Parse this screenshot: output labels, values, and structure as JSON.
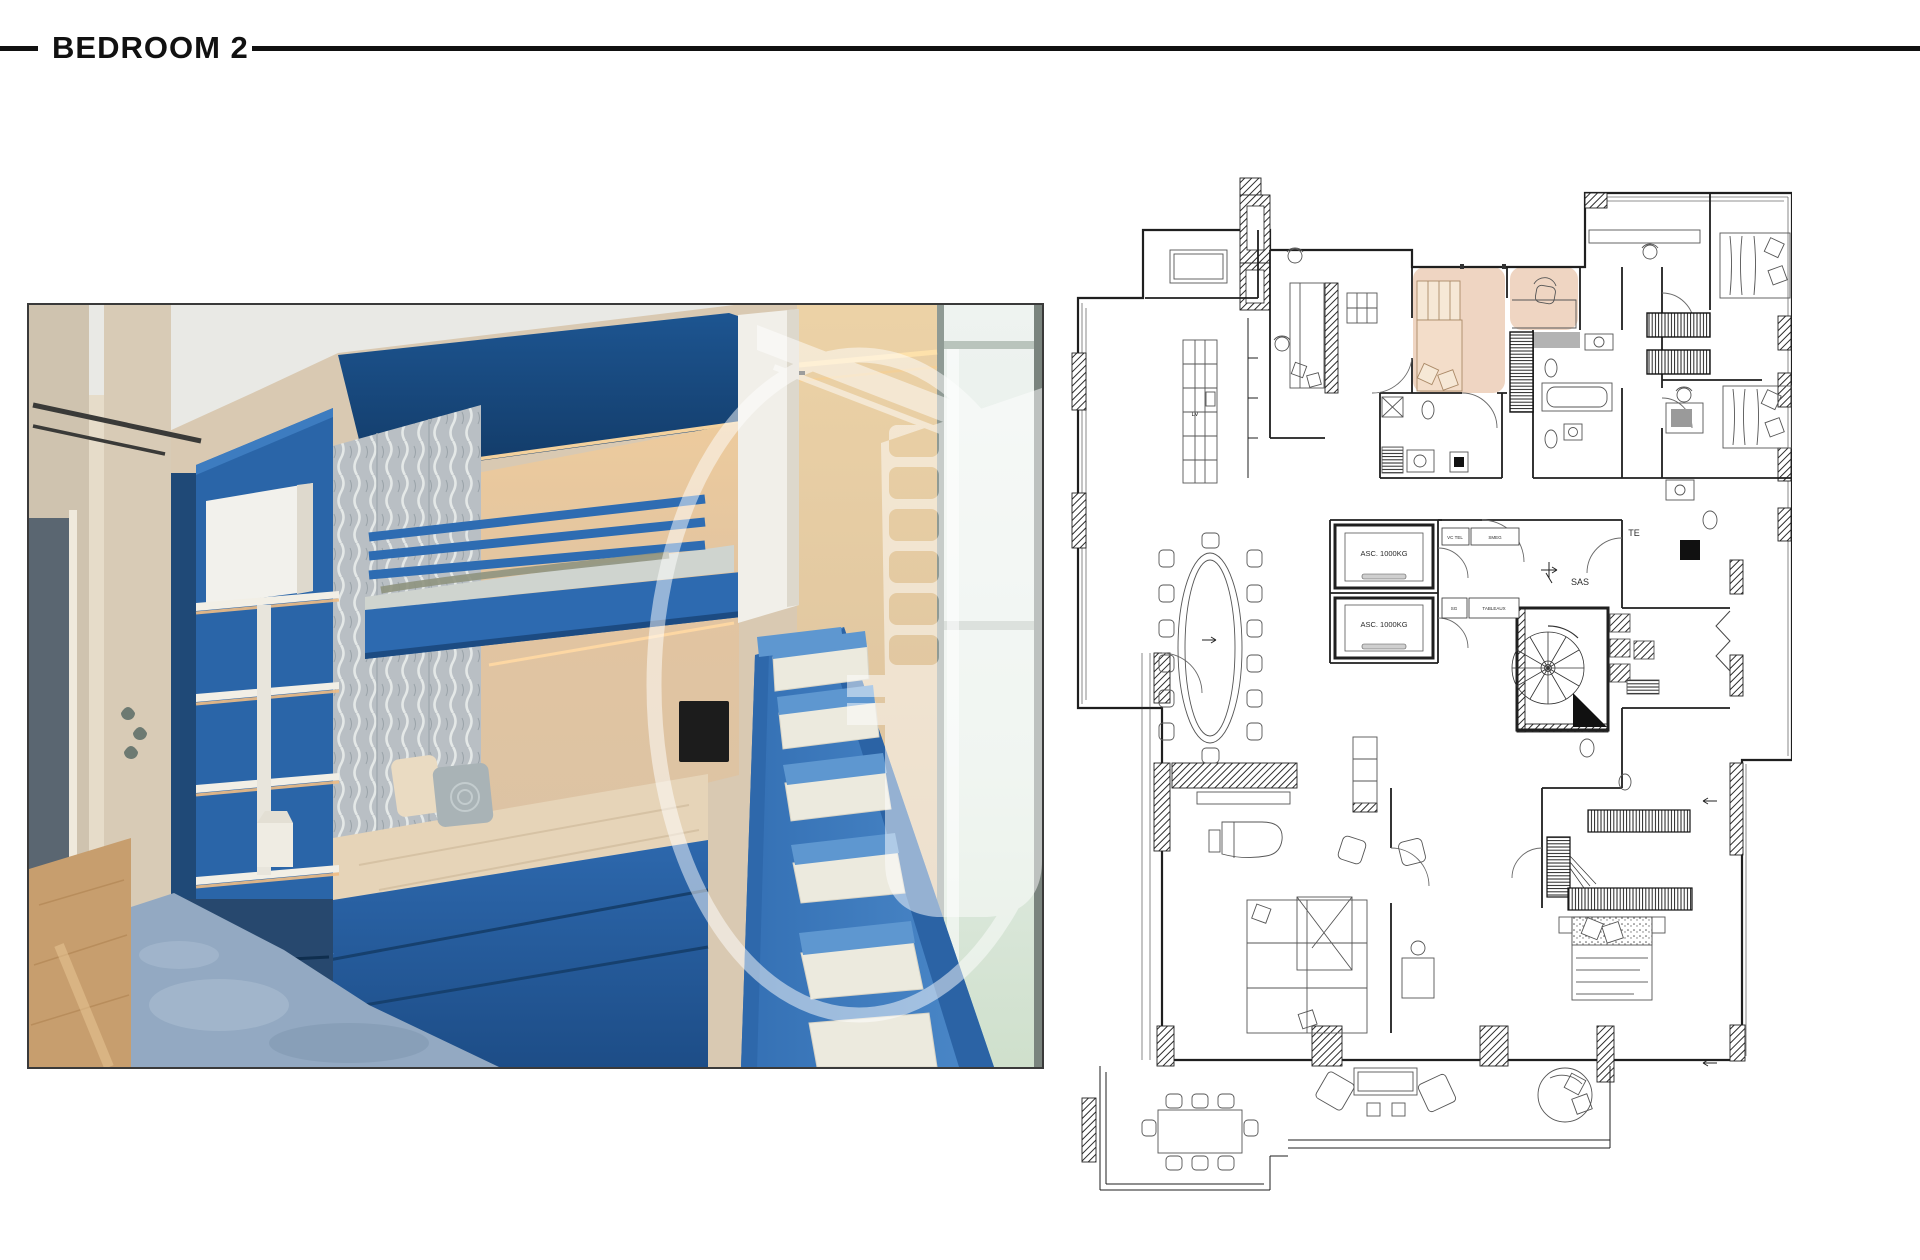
{
  "header": {
    "title": "BEDROOM 2"
  },
  "photo": {
    "watermark_icon": "building-tower-in-ring",
    "colors": {
      "bunk_blue": "#2e6cb2",
      "deep_canopy_blue": "#1b4c82",
      "stair_blue": "#3b7cc0",
      "warm_glow": "#f2c897",
      "bedding_cream": "#e6d4b8",
      "carpet_blue_gray": "#93a9c2",
      "wood_floor": "#c79e6e",
      "headboard_gray": "#b9bfc4"
    }
  },
  "floor_plan": {
    "highlight_color": "#eac7ae",
    "labels": {
      "elevator_1": "ASC. 1000KG",
      "elevator_2": "ASC. 1000KG",
      "dishwasher": "LV",
      "sas": "SAS",
      "te": "TE",
      "vc_tel": "VC TEL",
      "smeg": "SMEG",
      "sg": "SG",
      "tableaux": "TABLEAUX"
    }
  }
}
